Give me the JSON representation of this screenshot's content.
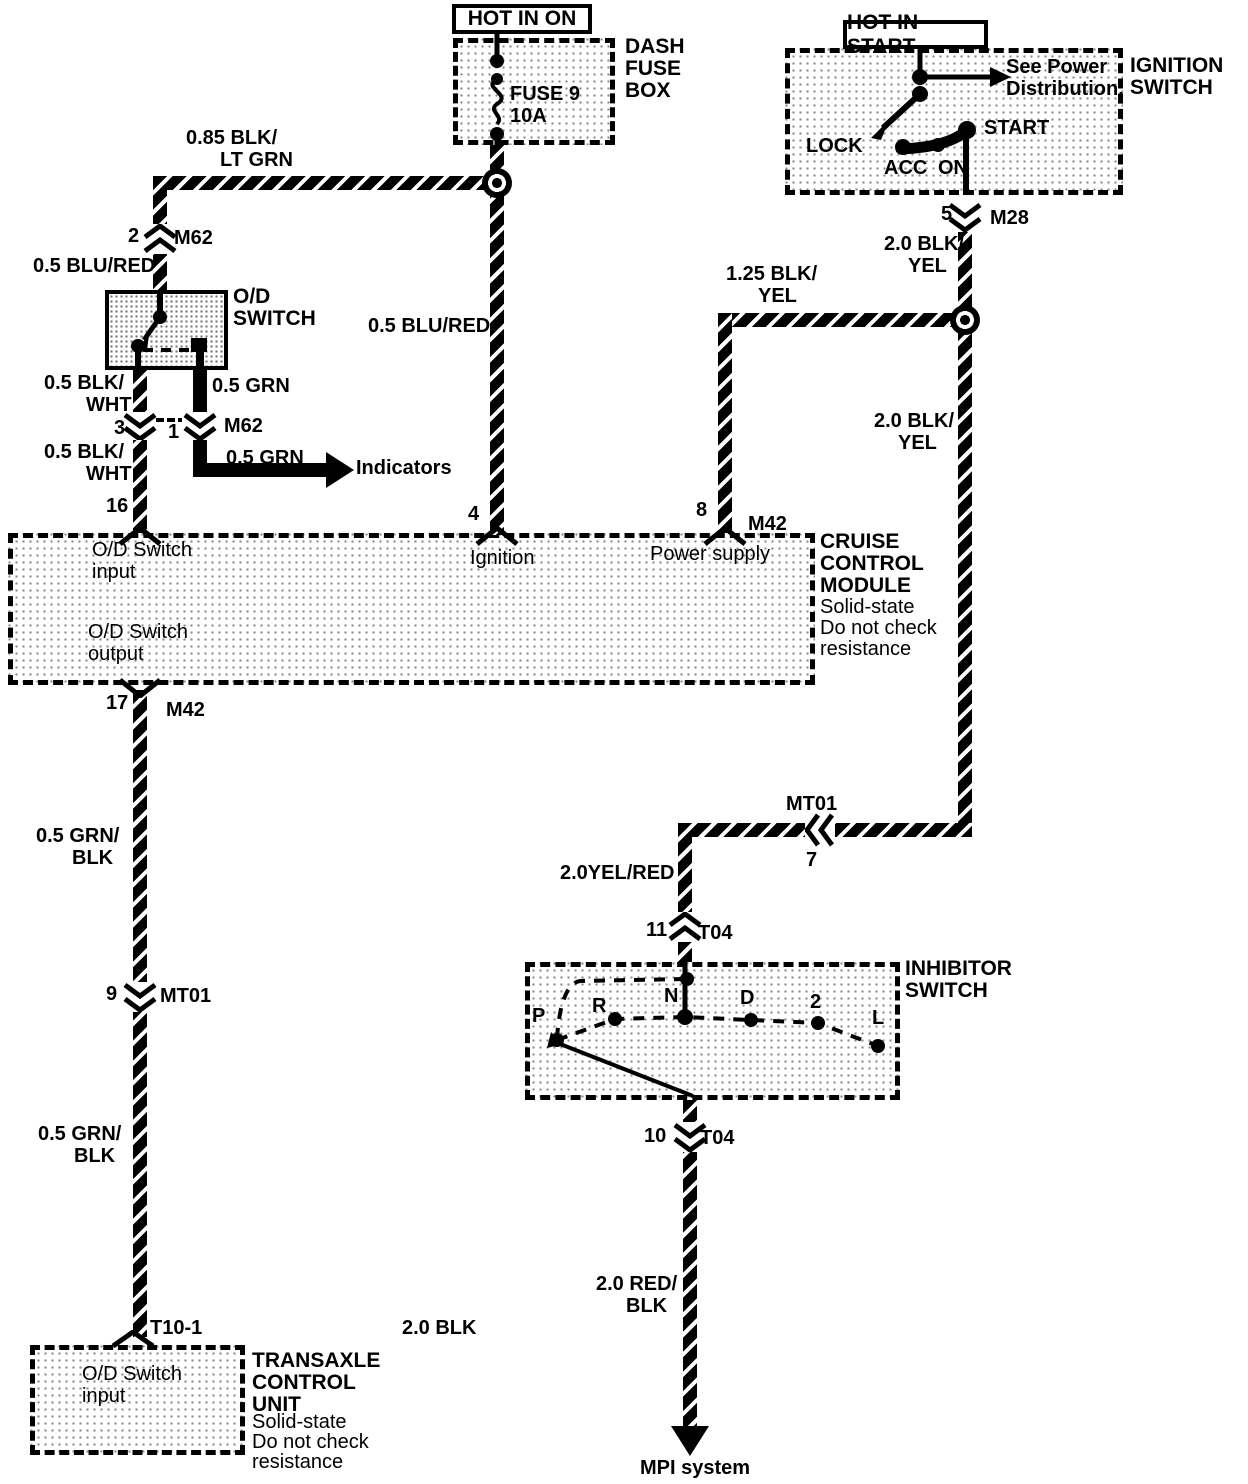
{
  "tags": {
    "hot_in_on": "HOT IN ON",
    "hot_in_start": "HOT IN START"
  },
  "fuse_box": {
    "title": [
      "DASH",
      "FUSE",
      "BOX"
    ],
    "fuse": "FUSE 9",
    "rating": "10A"
  },
  "ignition": {
    "title": [
      "IGNITION",
      "SWITCH"
    ],
    "note": [
      "See Power",
      "Distribution."
    ],
    "lock": "LOCK",
    "acc": "ACC",
    "on": "ON",
    "start": "START",
    "pin": "5",
    "connector": "M28"
  },
  "od_switch": {
    "title": [
      "O/D",
      "SWITCH"
    ]
  },
  "cruise": {
    "title": [
      "CRUISE",
      "CONTROL",
      "MODULE"
    ],
    "notes": [
      "Solid-state",
      "Do not check",
      "resistance"
    ],
    "input": [
      "O/D Switch",
      "input"
    ],
    "ignition": "Ignition",
    "power": "Power supply",
    "output": [
      "O/D Switch",
      "output"
    ],
    "pin_input": "16",
    "pin_ignition": "4",
    "pin_power": "8",
    "pin_output": "17",
    "conn_power": "M42",
    "conn_output": "M42"
  },
  "inhibitor": {
    "title": [
      "INHIBITOR",
      "SWITCH"
    ],
    "positions": [
      "P",
      "R",
      "N",
      "D",
      "2",
      "L"
    ]
  },
  "transaxle": {
    "title": [
      "TRANSAXLE",
      "CONTROL",
      "UNIT"
    ],
    "notes": [
      "Solid-state",
      "Do not check",
      "resistance"
    ],
    "input": [
      "O/D Switch",
      "input"
    ],
    "connector": "T10-1"
  },
  "connectors": {
    "m62_top": {
      "pin": "2",
      "name": "M62"
    },
    "m62_bottom": {
      "pin_left": "3",
      "pin_right": "1",
      "name": "M62"
    },
    "mt01_left": {
      "pin": "9",
      "name": "MT01"
    },
    "mt01_right": {
      "pin": "7",
      "name": "MT01"
    },
    "t04_top": {
      "pin": "11",
      "name": "T04"
    },
    "t04_bottom": {
      "pin": "10",
      "name": "T04"
    }
  },
  "wire_labels": {
    "blk_ltgrn": [
      "0.85 BLK/",
      "LT GRN"
    ],
    "blu_red_left": "0.5 BLU/RED",
    "blu_red_mid": "0.5 BLU/RED",
    "blk_wht_upper": [
      "0.5 BLK/",
      "WHT"
    ],
    "blk_wht_lower": [
      "0.5 BLK/",
      "WHT"
    ],
    "grn_upper": "0.5 GRN",
    "grn_lower": "0.5 GRN",
    "blk_yel_125": [
      "1.25 BLK/",
      "YEL"
    ],
    "blk_yel_upper": [
      "2.0 BLK/",
      "YEL"
    ],
    "blk_yel_lower": [
      "2.0 BLK/",
      "YEL"
    ],
    "grn_blk_upper": [
      "0.5 GRN/",
      "BLK"
    ],
    "grn_blk_lower": [
      "0.5 GRN/",
      "BLK"
    ],
    "yel_red": "2.0YEL/RED",
    "red_blk": [
      "2.0 RED/",
      "BLK"
    ],
    "blk_20": "2.0 BLK"
  },
  "destinations": {
    "indicators": "Indicators",
    "mpi": "MPI system"
  },
  "colors": {
    "line": "#000000",
    "background": "#ffffff",
    "stipple": "#8a8a8a"
  }
}
